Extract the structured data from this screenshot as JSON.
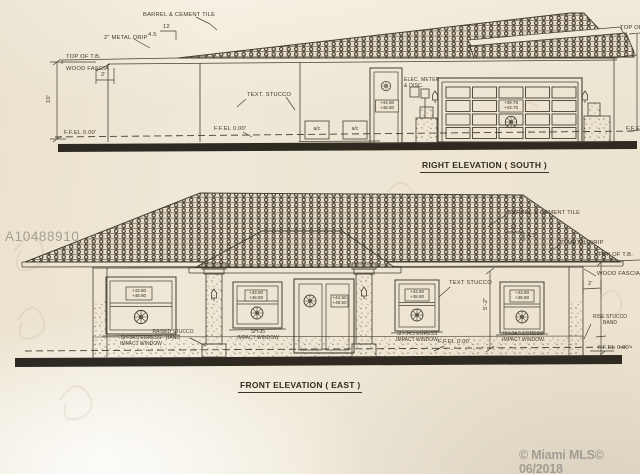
{
  "photo": {
    "mls_id_watermark": "A10488910",
    "mls_watermark": "© Miami MLS© 06/2018"
  },
  "right_elevation": {
    "title": "RIGHT ELEVATION ( SOUTH )",
    "labels": {
      "barrel_tile": "BARREL & CEMENT TILE",
      "metal_drip": "2\" METAL DRIP",
      "pitch_run": "12",
      "pitch_rise": "4.5",
      "top_of_tb": "TOP OF T.B.",
      "wood_fascia": "WOOD FASCIA",
      "overhang_dim": "2'",
      "wall_height_dim": "10'",
      "text_stucco": "TEXT. STUCCO",
      "ffel_left": "F.F.EL 0.00'",
      "ffel_mid": "F.F.EL 0.00'",
      "elec_meter_line1": "ELEC. METER",
      "elec_meter_line2": "& DISC.",
      "top_of_partial": "TOP OF",
      "ffe_partial": "F.F.E",
      "ac_unit": "a/c",
      "door_datum_line1": "+44.50",
      "door_datum_line2": "+48.50",
      "garage_datum_line1": "+39.75",
      "garage_datum_line2": "+43.75"
    }
  },
  "front_elevation": {
    "title": "FRONT ELEVATION ( EAST )",
    "labels": {
      "barrel_tile": "BARREL & CEMENT TILE",
      "pitch_run": "12",
      "pitch_rise": "4.5",
      "metal_drip": "2\" METAL DRIP",
      "top_of_tb": "TOP OF T.B.",
      "wood_fascia": "WOOD FASCIA",
      "overhang_dim": "2'",
      "text_stucco": "TEXT STUCCO",
      "rise_band_line1": "RISE STUCCO",
      "rise_band_line2": "BAND",
      "raised_band_line1": "RAISED STUCCO",
      "raised_band_line2": "BAND",
      "ffel_mid": "F.F.EL 0.00'",
      "ffel_right": "F.F.EL 0.00'",
      "window_height_dim": "5'-2\"",
      "egress_caption_line1": "SH-34.5 EGRESS",
      "egress_caption_line2": "IMPACT WINDOW",
      "entry_caption_line1": "SH-35",
      "entry_caption_line2": "IMPACT WINDOW",
      "window_datum_line1": "+43.80",
      "window_datum_line2": "+48.80",
      "door_datum_line1": "+44.50",
      "door_datum_line2": "+48.50"
    }
  }
}
